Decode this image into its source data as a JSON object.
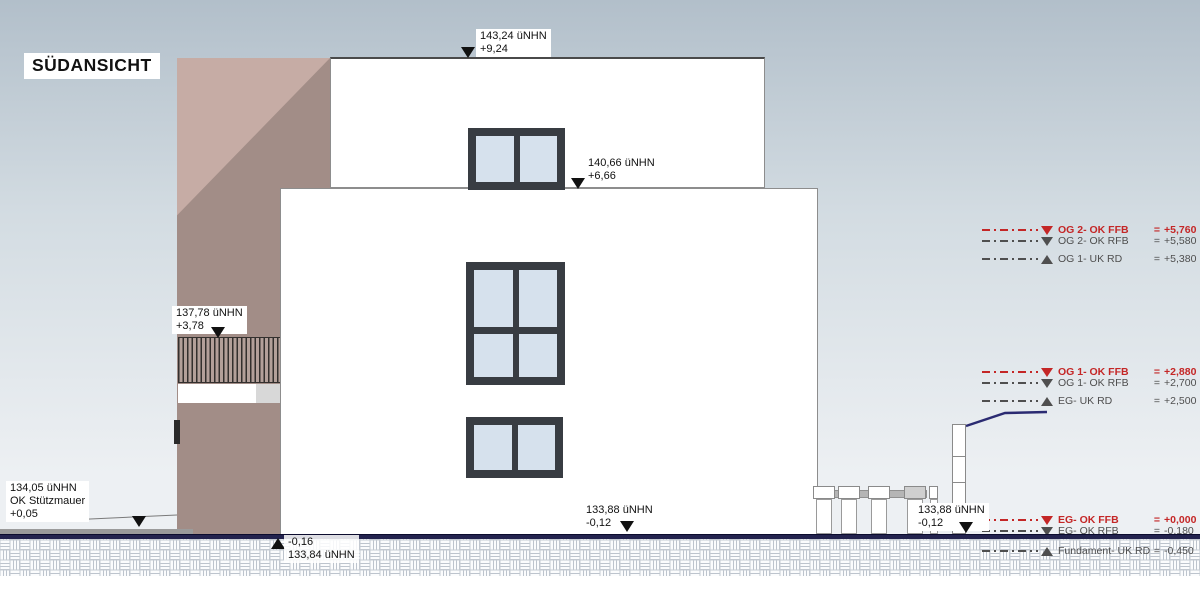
{
  "title": "SÜDANSICHT",
  "colors": {
    "bg_top": "#b2bfca",
    "bg_bottom": "#edf0f3",
    "mauve_light": "#c6aca5",
    "mauve_dark": "#a28d87",
    "window_frame": "#383c42",
    "window_glass": "#d6e1ed",
    "building_outline": "#8d8d8d",
    "ground_navy": "#23234e",
    "terrain_blue": "#2b2b72",
    "red_annotation": "#c42626",
    "gray_annotation": "#4f4f4f",
    "hatch_line": "#bdc4cd",
    "marker_ink": "#111111"
  },
  "markers": {
    "roof": {
      "line1": "143,24 üNHN",
      "line2": "+9,24"
    },
    "og_top": {
      "line1": "140,66 üNHN",
      "line2": "+6,66"
    },
    "balcony": {
      "line1": "137,78 üNHN",
      "line2": "+3,78"
    },
    "retaining_wall": {
      "line1": "134,05 üNHN",
      "line2": "OK Stützmauer",
      "line3": "+0,05"
    },
    "ground_center": {
      "line1": "133,88 üNHN",
      "line2": "-0,12"
    },
    "ground_right": {
      "line1": "133,88 üNHN",
      "line2": "-0,12"
    },
    "below_ground": {
      "line1": "-0,16",
      "line2": "133,84 üNHN"
    }
  },
  "annotations": {
    "eq": "=",
    "rows": [
      {
        "label": "OG 2- OK FFB",
        "value": "+5,760"
      },
      {
        "label": "OG 2- OK RFB",
        "value": "+5,580"
      },
      {
        "label": "OG 1- UK RD",
        "value": "+5,380"
      },
      {
        "label": "OG 1- OK FFB",
        "value": "+2,880"
      },
      {
        "label": "OG 1- OK RFB",
        "value": "+2,700"
      },
      {
        "label": "EG- UK RD",
        "value": "+2,500"
      },
      {
        "label": "EG- OK FFB",
        "value": "+0,000"
      },
      {
        "label": "EG- OK RFB",
        "value": "-0,180"
      },
      {
        "label": "Fundament- UK RD",
        "value": "-0,450"
      }
    ]
  }
}
